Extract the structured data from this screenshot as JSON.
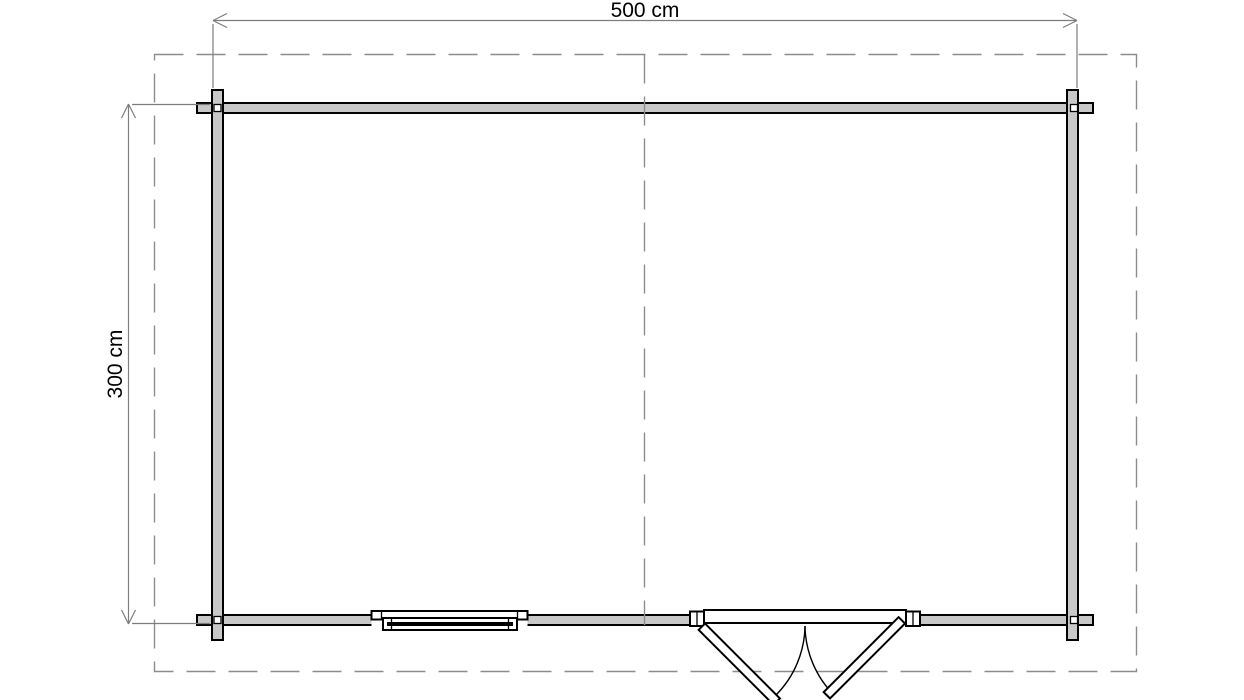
{
  "drawing": {
    "labels": {
      "width": "500 cm",
      "depth": "300 cm"
    }
  },
  "colors": {
    "wall_fill": "#c8c8c8",
    "outline": "#000000",
    "dimension": "#7d7d7d",
    "dashed": "#8c8c8c",
    "background": "#ffffff"
  }
}
